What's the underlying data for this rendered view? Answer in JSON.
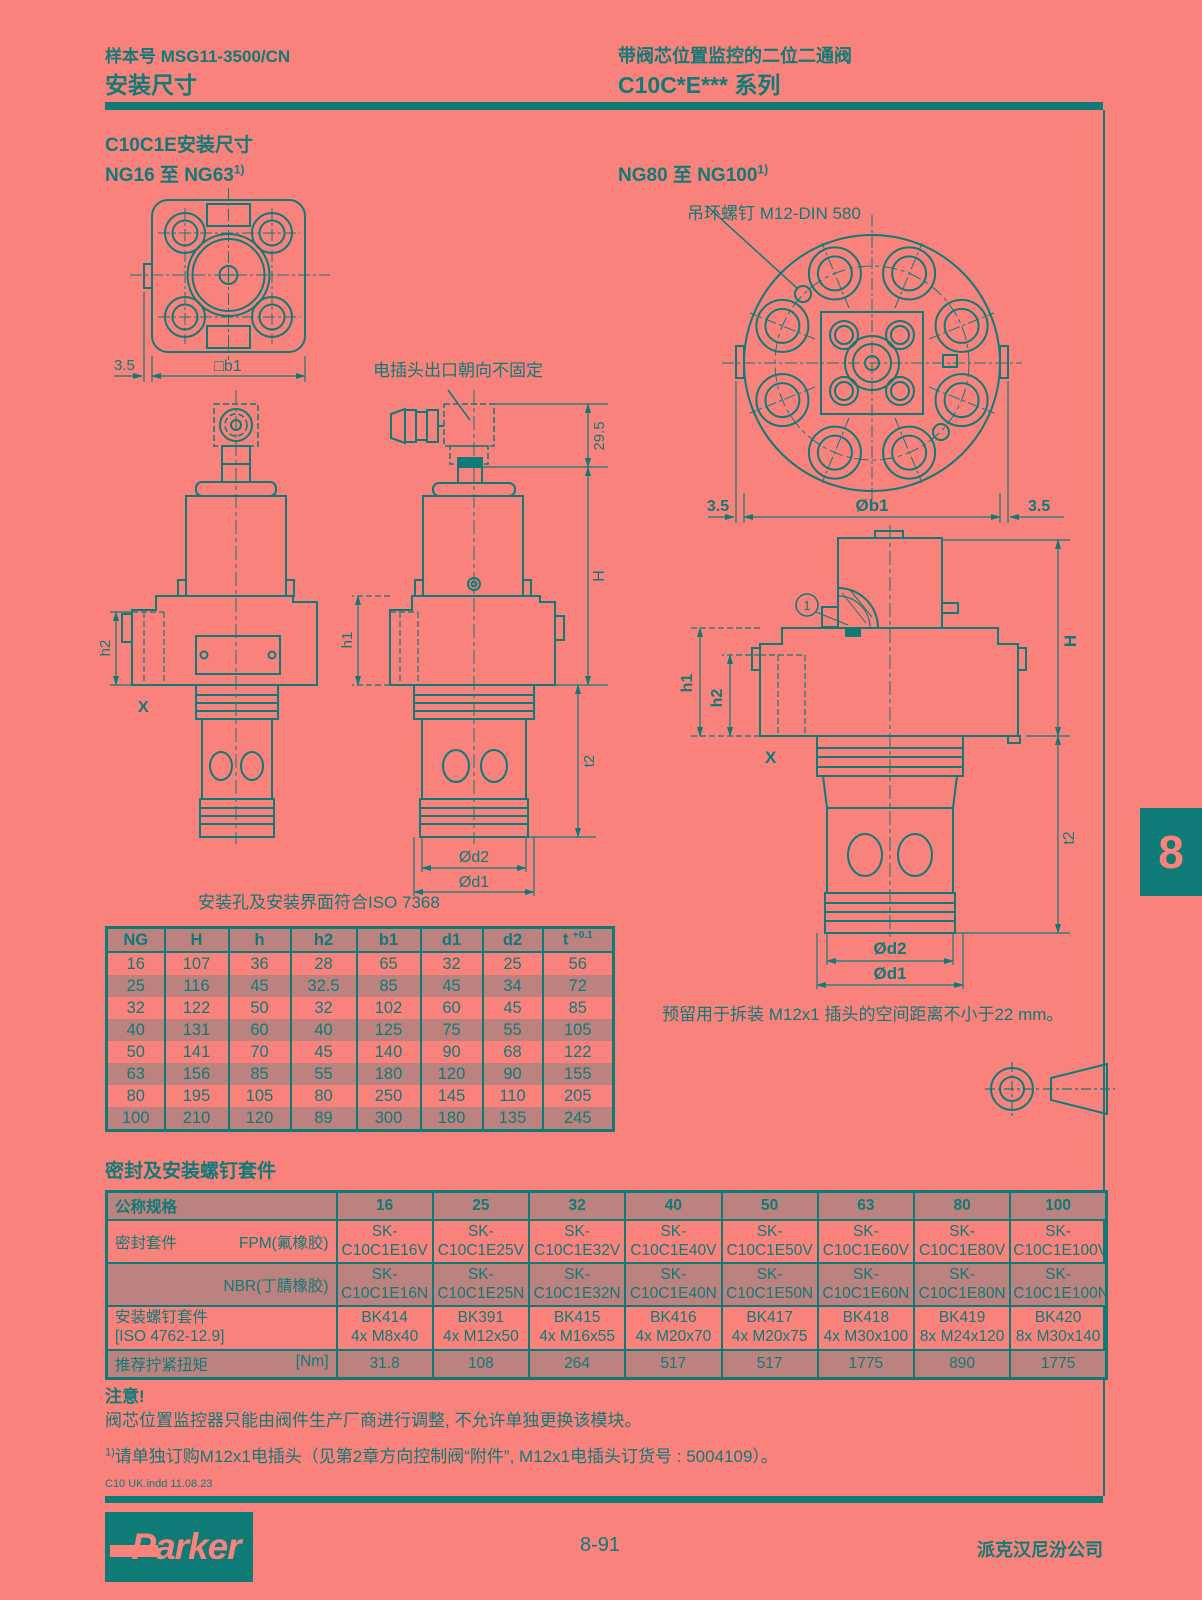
{
  "colors": {
    "background": "#F9827D",
    "ink": "#0E7B76",
    "stripe": "#BB8280"
  },
  "header": {
    "catalog_label": "样本号 MSG11-3500/CN",
    "page_title": "安装尺寸",
    "product_line1": "带阀芯位置监控的二位二通阀",
    "product_line2": "C10C*E*** 系列"
  },
  "sections": {
    "mounting_title": "C10C1E安装尺寸",
    "range_left": "NG16 至 NG63",
    "range_right": "NG80 至 NG100",
    "range_footnote_sup": "1)",
    "seal_title": "密封及安装螺钉套件"
  },
  "drawings": {
    "plug_orientation_note": "电插头出口朝向不固定",
    "eyebolt_label": "吊环螺钉 M12-DIN 580",
    "iso_note": "安装孔及安装界面符合ISO 7368",
    "clearance_note": "预留用于拆装 M12x1 插头的空间距离不小于22 mm。",
    "dims": {
      "offset35": "3.5",
      "b1_square": "□b1",
      "plug_height": "29.5",
      "H": "H",
      "h1": "h1",
      "h2": "h2",
      "X": "X",
      "t2": "t2",
      "d2": "Ød2",
      "d1": "Ød1",
      "b1_dia": "Øb1",
      "callout1": "1"
    }
  },
  "dim_table": {
    "headers": [
      "NG",
      "H",
      "h",
      "h2",
      "b1",
      "d1",
      "d2"
    ],
    "header_t_base": "t",
    "header_t_sup": "+0.1",
    "rows": [
      [
        "16",
        "107",
        "36",
        "28",
        "65",
        "32",
        "25",
        "56"
      ],
      [
        "25",
        "116",
        "45",
        "32.5",
        "85",
        "45",
        "34",
        "72"
      ],
      [
        "32",
        "122",
        "50",
        "32",
        "102",
        "60",
        "45",
        "85"
      ],
      [
        "40",
        "131",
        "60",
        "40",
        "125",
        "75",
        "55",
        "105"
      ],
      [
        "50",
        "141",
        "70",
        "45",
        "140",
        "90",
        "68",
        "122"
      ],
      [
        "63",
        "156",
        "85",
        "55",
        "180",
        "120",
        "90",
        "155"
      ],
      [
        "80",
        "195",
        "105",
        "80",
        "250",
        "145",
        "110",
        "205"
      ],
      [
        "100",
        "210",
        "120",
        "89",
        "300",
        "180",
        "135",
        "245"
      ]
    ]
  },
  "seal_table": {
    "spec_label": "公称规格",
    "sizes": [
      "16",
      "25",
      "32",
      "40",
      "50",
      "63",
      "80",
      "100"
    ],
    "seal_kit_label": "密封套件",
    "fpm_label": "FPM(氟橡胶)",
    "nbr_label": "NBR(丁腈橡胶)",
    "sk_prefix": "SK-",
    "fpm_codes": [
      "C10C1E16V",
      "C10C1E25V",
      "C10C1E32V",
      "C10C1E40V",
      "C10C1E50V",
      "C10C1E60V",
      "C10C1E80V",
      "C10C1E100V"
    ],
    "nbr_codes": [
      "C10C1E16N",
      "C10C1E25N",
      "C10C1E32N",
      "C10C1E40N",
      "C10C1E50N",
      "C10C1E60N",
      "C10C1E80N",
      "C10C1E100N"
    ],
    "bolt_label_line1": "安装螺钉套件",
    "bolt_label_line2": "[ISO 4762-12.9]",
    "bolt_kits": [
      "BK414",
      "BK391",
      "BK415",
      "BK416",
      "BK417",
      "BK418",
      "BK419",
      "BK420"
    ],
    "bolt_screws": [
      "4x M8x40",
      "4x M12x50",
      "4x M16x55",
      "4x M20x70",
      "4x M20x75",
      "4x M30x100",
      "8x M24x120",
      "8x M30x140"
    ],
    "torque_label": "推荐拧紧扭矩",
    "torque_unit": "[Nm]",
    "torque_values": [
      "31.8",
      "108",
      "264",
      "517",
      "517",
      "1775",
      "890",
      "1775"
    ]
  },
  "notes": {
    "attention_title": "注意!",
    "attention_body": "阀芯位置监控器只能由阀件生产厂商进行调整, 不允许单独更换该模块。",
    "footnote_sup": "1)",
    "footnote_body": "请单独订购M12x1电插头（见第2章方向控制阀“附件”, M12x1电插头订货号 : 5004109）。",
    "print_note": "C10 UK.indd  11.08.23"
  },
  "footer": {
    "page_number": "8-91",
    "company": "派克汉尼汾公司",
    "brand": "Parker"
  },
  "side_tab": {
    "number": "8"
  }
}
